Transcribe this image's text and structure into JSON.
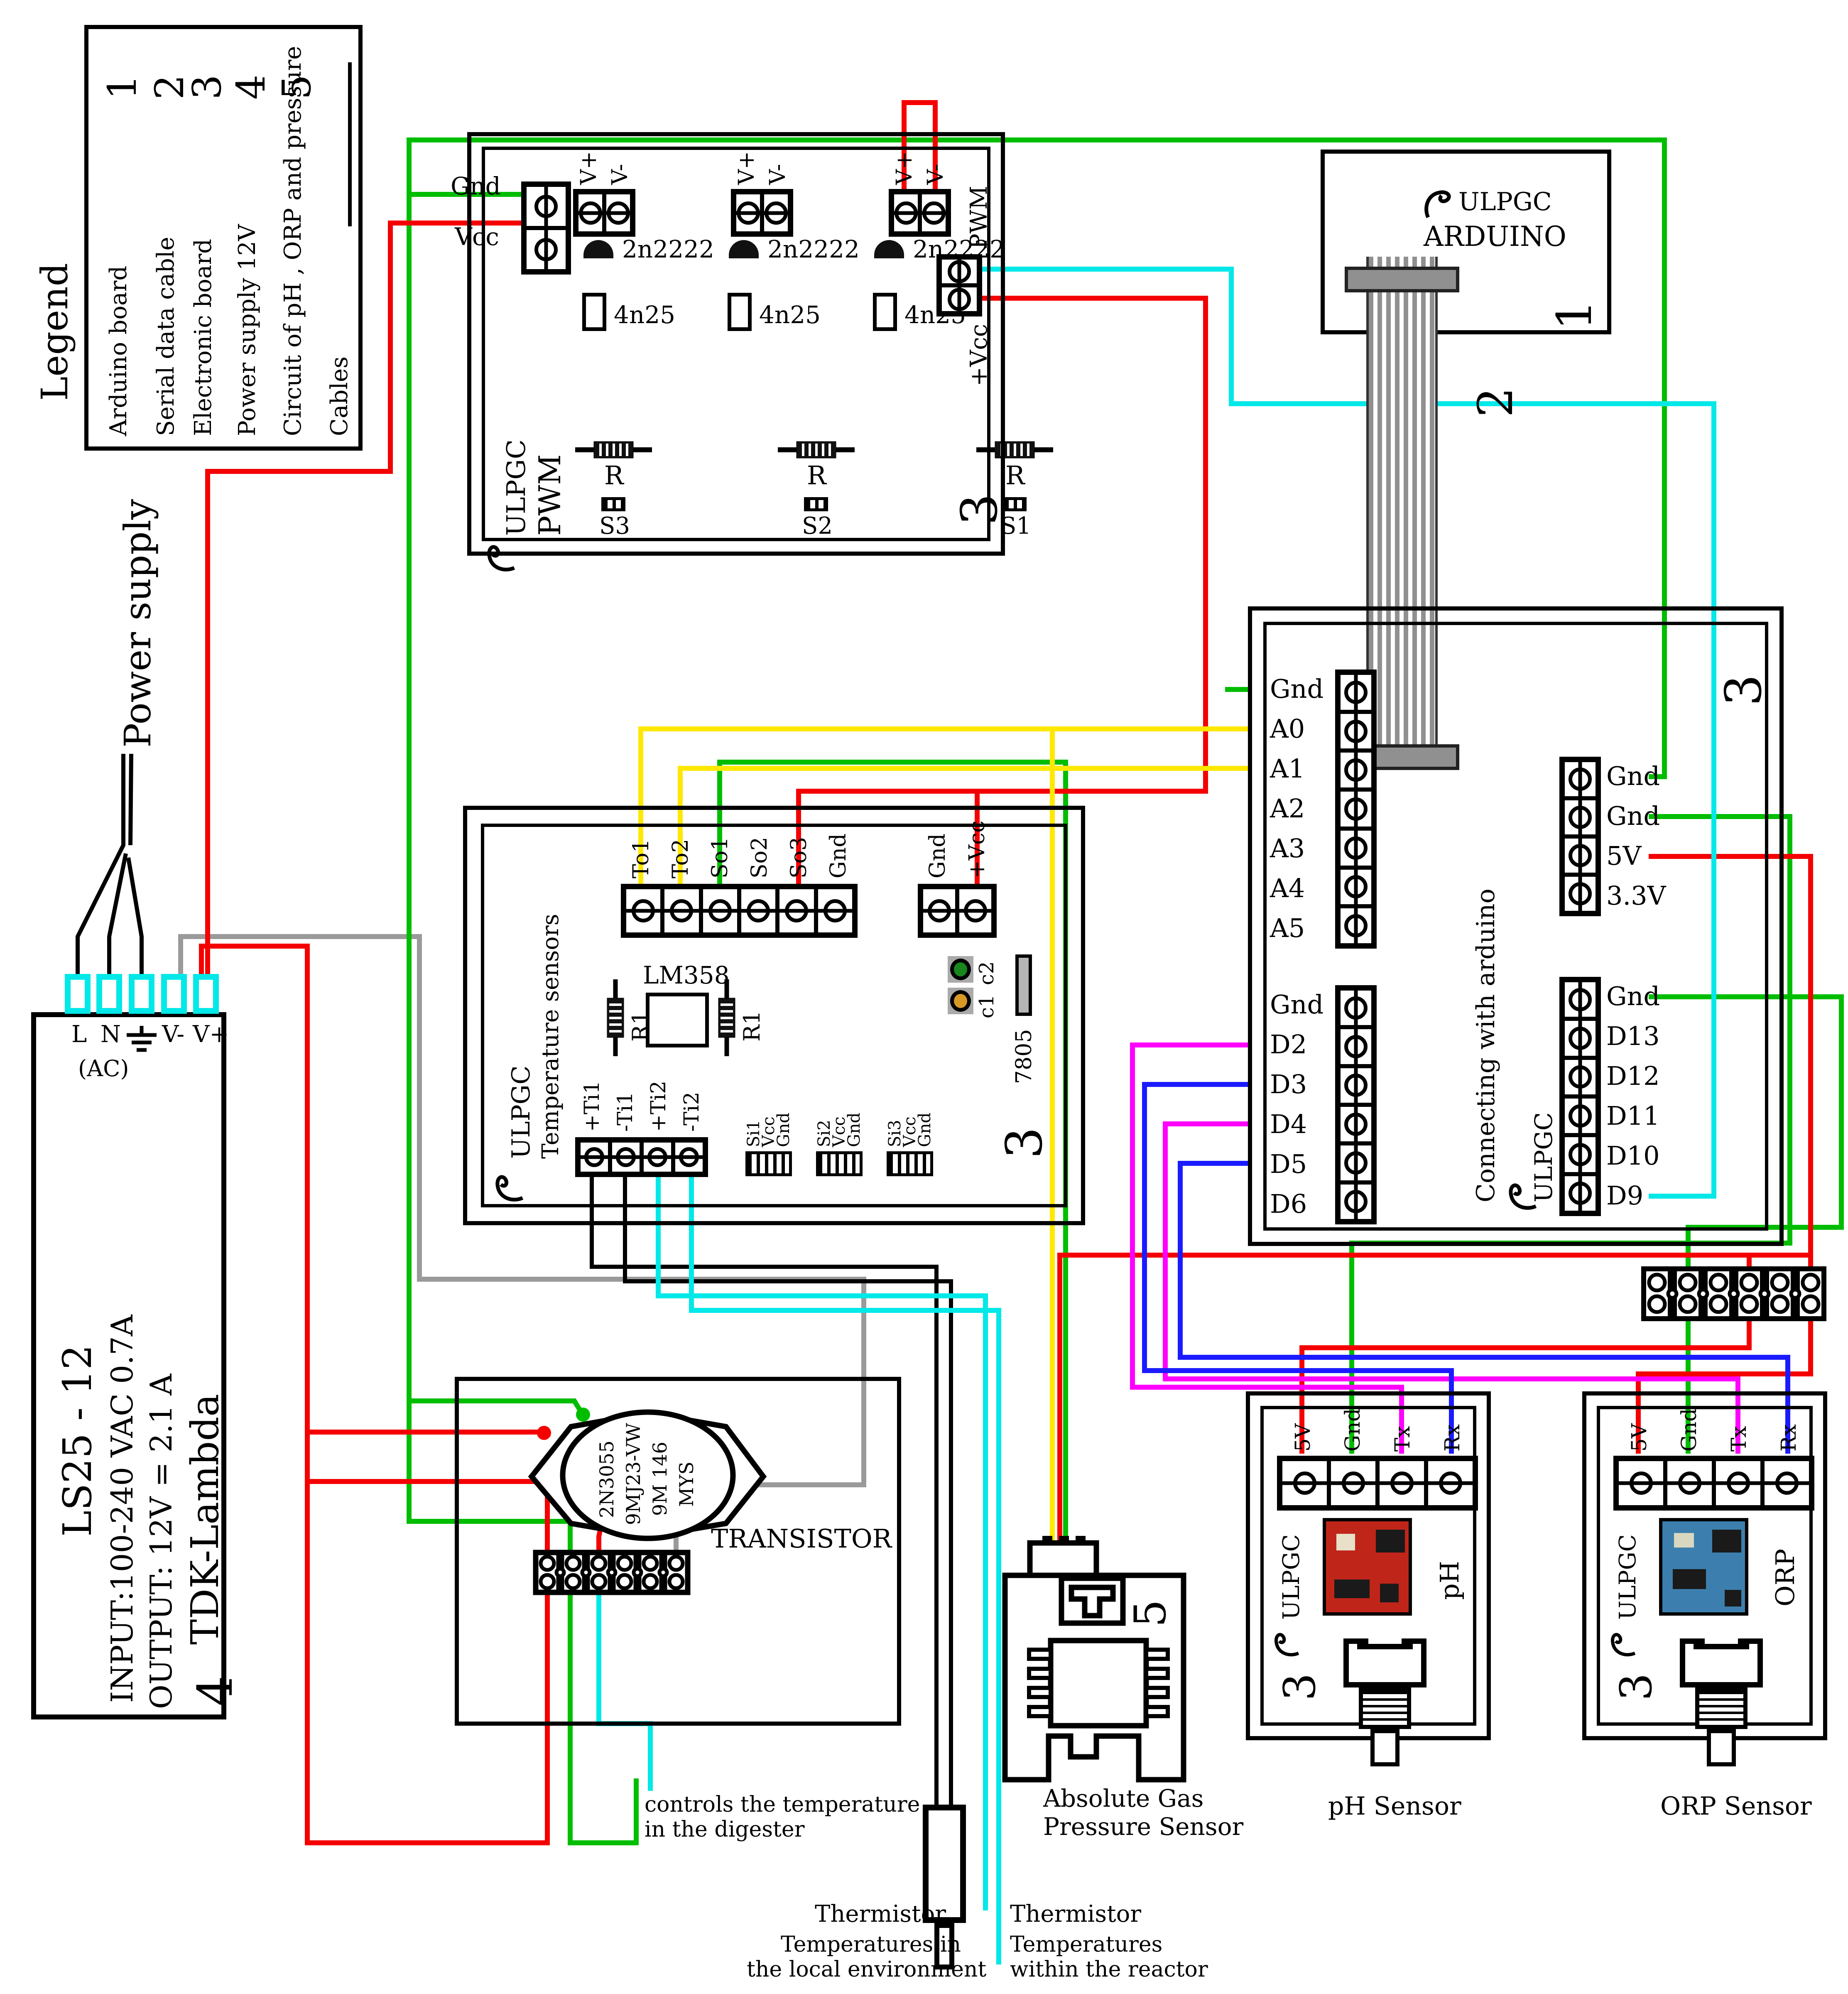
{
  "legend": {
    "title": "Legend",
    "items": [
      {
        "label": "Arduino board",
        "num": "1"
      },
      {
        "label": "Serial data cable",
        "num": "2"
      },
      {
        "label": "Electronic board",
        "num": "3"
      },
      {
        "label": "Power supply 12V",
        "num": "4"
      },
      {
        "label": "Circuit of pH , ORP and pressure",
        "num": "5"
      },
      {
        "label": "Cables",
        "num": ""
      }
    ]
  },
  "power_supply": {
    "label": "Power supply",
    "ac": "(AC)",
    "terminals": [
      "L",
      "N",
      "",
      "V-",
      "V+"
    ],
    "model": "LS25 - 12",
    "input": "INPUT:100-240 VAC  0.7A",
    "output": "OUTPUT: 12V = 2.1 A",
    "brand": "TDK-Lambda",
    "ref": "4"
  },
  "pwm": {
    "brand": "ULPGC",
    "name": "PWM",
    "ref": "3",
    "gnd": "Gnd",
    "vcc": "Vcc",
    "vplus": "V+",
    "vminus": "V-",
    "transistor": "2n2222",
    "opto": "4n25",
    "res": "R",
    "s": [
      "S3",
      "S2",
      "S1"
    ],
    "pwm_out": "PWM",
    "pvcc": "+Vcc"
  },
  "arduino": {
    "brand": "ULPGC",
    "name": "ARDUINO",
    "ref": "1",
    "cable_ref": "2"
  },
  "conn": {
    "ref": "3",
    "title": "Connecting with arduino",
    "brand": "ULPGC",
    "lt": [
      "Gnd",
      "A0",
      "A1",
      "A2",
      "A3",
      "A4",
      "A5"
    ],
    "lb": [
      "Gnd",
      "D2",
      "D3",
      "D4",
      "D5",
      "D6"
    ],
    "rt": [
      "Gnd",
      "Gnd",
      "5V",
      "3.3V"
    ],
    "rb": [
      "Gnd",
      "D13",
      "D12",
      "D11",
      "D10",
      "D9"
    ]
  },
  "temp": {
    "brand": "ULPGC",
    "name": "Temperature sensors",
    "ref": "3",
    "top": [
      "To1",
      "To2",
      "So1",
      "So2",
      "So3",
      "Gnd"
    ],
    "pwr": [
      "Gnd",
      "+Vcc"
    ],
    "ic": "LM358",
    "r1": "R1",
    "c1": "c1",
    "c2": "c2",
    "reg": "7805",
    "ti": [
      "+Ti1",
      "-Ti1",
      "+Ti2",
      "-Ti2"
    ],
    "si": [
      [
        "Si1",
        "Vcc",
        "Gnd"
      ],
      [
        "Si2",
        "Vcc",
        "Gnd"
      ],
      [
        "Si3",
        "Vcc",
        "Gnd"
      ]
    ]
  },
  "trans": {
    "l1": "2N3055",
    "l2": "9MJ23-VW",
    "l3": "9M 146",
    "l4": "MYS",
    "label": "TRANSISTOR",
    "note1": "controls the temperature",
    "note2": "in the digester"
  },
  "press": {
    "ref": "5",
    "label1": "Absolute Gas",
    "label2": "Pressure Sensor"
  },
  "ph": {
    "brand": "ULPGC",
    "terms": [
      "5V",
      "Gnd",
      "Tx",
      "Rx"
    ],
    "ref_circuit": "5",
    "ref_board": "3",
    "name": "pH",
    "label": "pH Sensor"
  },
  "orp": {
    "brand": "ULPGC",
    "terms": [
      "5V",
      "Gnd",
      "Tx",
      "Rx"
    ],
    "ref_circuit": "5",
    "ref_board": "3",
    "name": "ORP",
    "label": "ORP Sensor"
  },
  "therm1": {
    "title": "Thermistor",
    "n1": "Temperatures in",
    "n2": "the local environment"
  },
  "therm2": {
    "title": "Thermistor",
    "n1": "Temperatures",
    "n2": "within the reactor"
  },
  "colors": {
    "wire_red": "#f50000",
    "wire_green": "#00bd00",
    "wire_cyan": "#00e8e8",
    "wire_yellow": "#ffe800",
    "wire_magenta": "#ff00ff",
    "wire_blue": "#1b1bff",
    "wire_gray": "#9a9a9a",
    "wire_black": "#000000",
    "psu_terminal": "#00e8e8",
    "pcb_ph": "#c0251a",
    "pcb_orp": "#3c7fae",
    "cap_c2": "#18861d",
    "cap_c1": "#d79a27"
  }
}
